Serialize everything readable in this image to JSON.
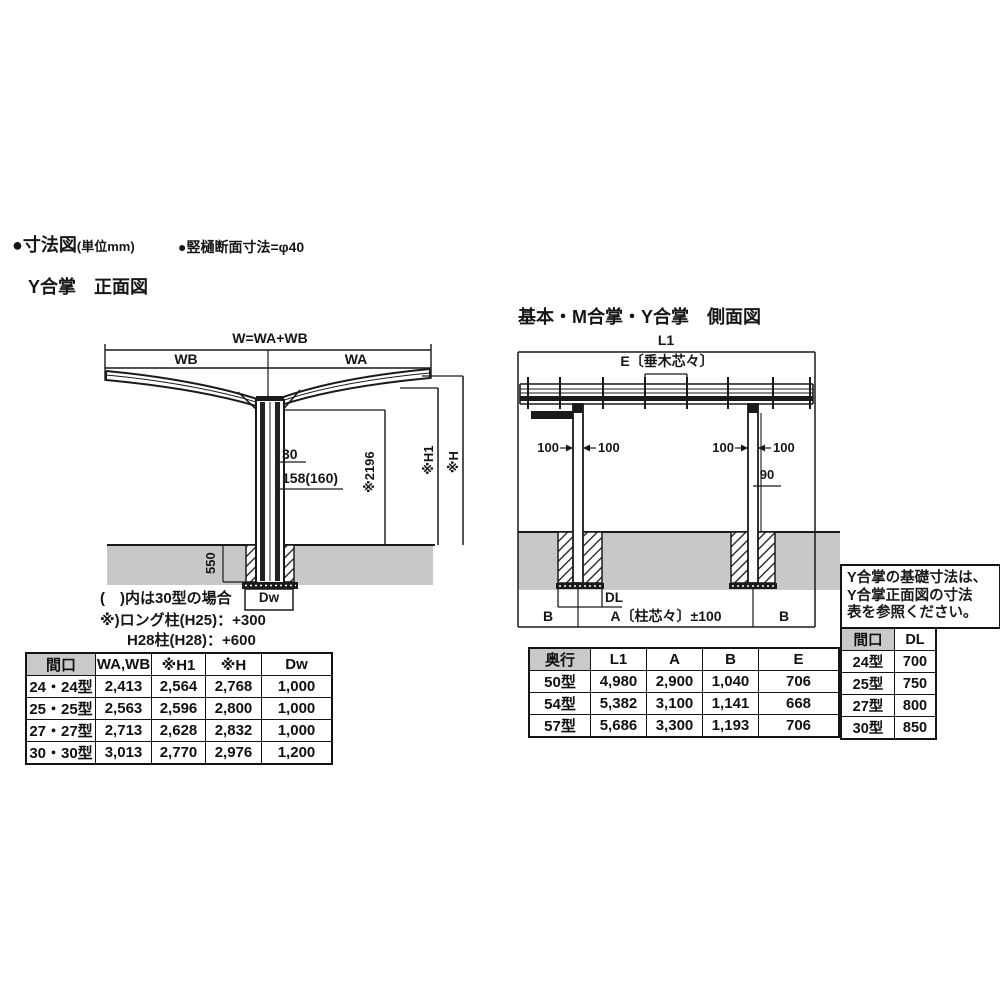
{
  "page": {
    "legend": {
      "title_main": "●寸法図",
      "title_unit": "(単位mm)",
      "note": "●竪樋断面寸法=φ40"
    },
    "colors": {
      "ground": "#c8c8c8",
      "table_header": "#c9c9c9",
      "line": "#1a1a1a"
    }
  },
  "front_view": {
    "title": "Y合掌　正面図",
    "labels": {
      "w_total": "W=WA+WB",
      "wb": "WB",
      "wa": "WA",
      "bracket_offset": "30",
      "column_size": "158(160)",
      "under_clearance": "※2196",
      "h1": "※H1",
      "h": "※H",
      "footing_depth": "550",
      "footing_width": "Dw"
    },
    "notes": [
      "(　)内は30型の場合",
      "※)ロング柱(H25)：+300",
      "H28柱(H28)：+600"
    ],
    "table": {
      "headers": [
        "間口",
        "WA,WB",
        "※H1",
        "※H",
        "Dw"
      ],
      "rows": [
        [
          "24・24型",
          "2,413",
          "2,564",
          "2,768",
          "1,000"
        ],
        [
          "25・25型",
          "2,563",
          "2,596",
          "2,800",
          "1,000"
        ],
        [
          "27・27型",
          "2,713",
          "2,628",
          "2,832",
          "1,000"
        ],
        [
          "30・30型",
          "3,013",
          "2,770",
          "2,976",
          "1,200"
        ]
      ]
    }
  },
  "side_view": {
    "title": "基本・M合掌・Y合掌　側面図",
    "labels": {
      "l1": "L1",
      "e": "E〔垂木芯々〕",
      "offset_left_outer": "100",
      "offset_left_inner": "100",
      "offset_right_outer": "100",
      "offset_right_inner": "100",
      "pipe_offset": "90",
      "b_left": "B",
      "a_span": "A〔柱芯々〕±100",
      "b_right": "B",
      "footing_width": "DL"
    },
    "table": {
      "headers": [
        "奥行",
        "L1",
        "A",
        "B",
        "E"
      ],
      "rows": [
        [
          "50型",
          "4,980",
          "2,900",
          "1,040",
          "706"
        ],
        [
          "54型",
          "5,382",
          "3,100",
          "1,141",
          "668"
        ],
        [
          "57型",
          "5,686",
          "3,300",
          "1,193",
          "706"
        ]
      ]
    }
  },
  "reference_note": {
    "lines": [
      "Y合掌の基礎寸法は、",
      "Y合掌正面図の寸法",
      "表を参照ください。"
    ]
  },
  "foundation_table": {
    "headers": [
      "間口",
      "DL"
    ],
    "rows": [
      [
        "24型",
        "700"
      ],
      [
        "25型",
        "750"
      ],
      [
        "27型",
        "800"
      ],
      [
        "30型",
        "850"
      ]
    ]
  }
}
